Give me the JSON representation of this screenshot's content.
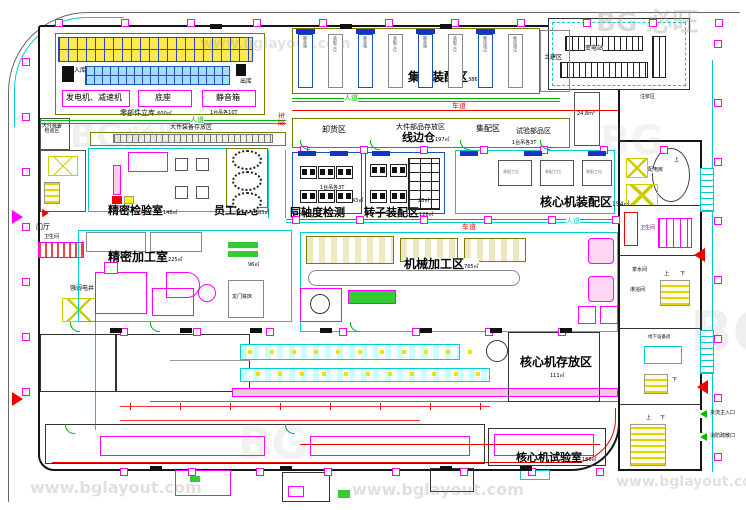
{
  "watermark": {
    "url": "www.bglayout.com",
    "brand_cn": "必旺",
    "brand_en": "BG"
  },
  "paths": {
    "pedestrian": "人道",
    "vehicle": "车道"
  },
  "storage": {
    "inbound": "入库",
    "outbound": "出库",
    "rack_label": "零部件立库",
    "rack_area": "600㎡",
    "rack_crane": "1台吊各10T",
    "box_generator": "发电机、减速机",
    "box_base": "底座",
    "box_silent": "静音箱",
    "large_equip_inspect_1": "大件装备",
    "large_equip_inspect_2": "检验区",
    "large_equip_store": "大件装备存放区"
  },
  "top": {
    "integrated_assembly": "集成装配区",
    "integrated_area": "386㎡",
    "slot_silent": "静音箱",
    "slot_station": "装配工位",
    "slot_debug": "集成调试",
    "civil": "土建区",
    "substation": "变电站",
    "grouting": "注浆区",
    "unloading": "卸货区",
    "large_parts_store": "大件部品存放区",
    "line_side": "线边仓",
    "line_side_area": "197㎡",
    "kitting": "集配区",
    "test_parts": "试验部品区",
    "room_248": "24.8m²"
  },
  "mid": {
    "precision_inspect": "精密检验室",
    "precision_inspect_area": "148㎡",
    "staff_garden": "员工园地",
    "staff_garden_area": "83㎡",
    "coaxiality": "同轴度检测",
    "rotor_assembly": "转子装配区",
    "rotor_area": "126㎡",
    "room_43": "43㎡",
    "room_28": "28㎡",
    "core_assembly": "核心机装配区",
    "core_assembly_area": "154㎡",
    "crane_3t": "1台吊各3T",
    "entrance_hall": "门厅",
    "toilet": "卫生间",
    "elec_shaft": "强弱电井",
    "precision_machining": "精密加工室",
    "precision_machining_area": "225㎡",
    "gantry_mill": "龙门铣床",
    "room_96": "96㎡",
    "machining": "机械加工区",
    "machining_area": "765㎡"
  },
  "right_wing": {
    "power_room": "配电房",
    "toilet": "卫生间",
    "tea_room": "茶水间",
    "shower": "淋浴间",
    "underground_equip": "地下设备房",
    "up": "上",
    "down": "下",
    "cargo_entrance": "货流主入口",
    "fire_exit": "消防疏散口"
  },
  "bottom": {
    "core_storage": "核心机存放区",
    "core_storage_area": "111㎡",
    "core_test": "核心机试验室",
    "core_test_area": "186㎡"
  }
}
